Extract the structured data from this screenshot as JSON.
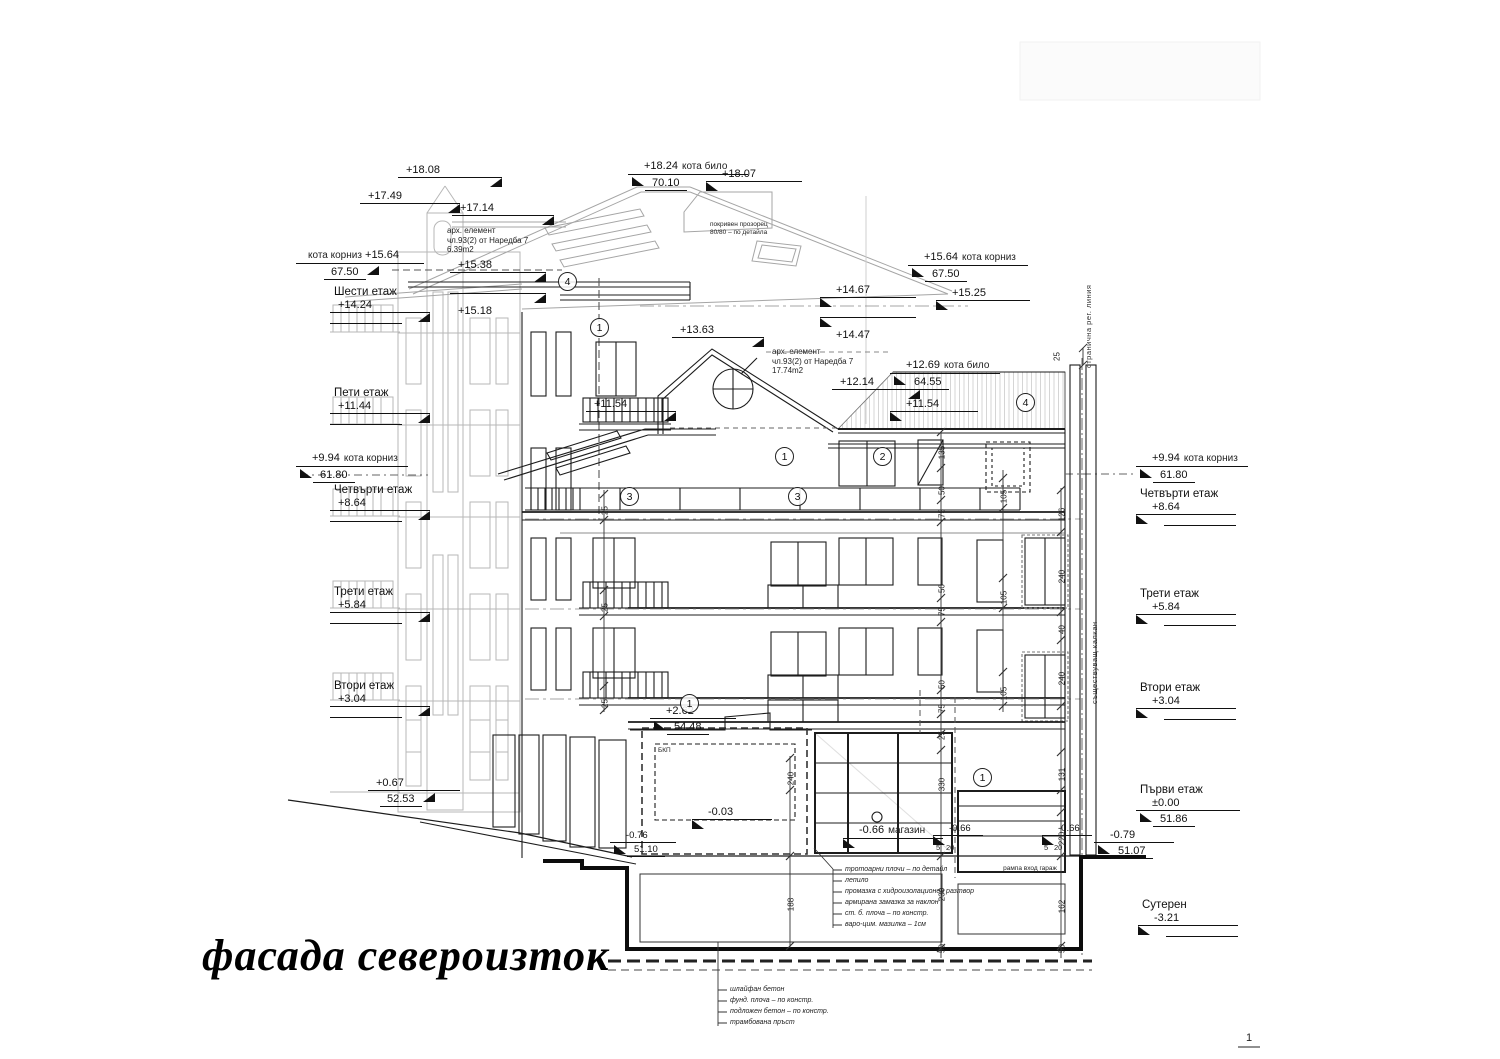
{
  "title": "фасада североизток",
  "page_number": "1",
  "levels": {
    "m1808": "+18.08",
    "m1749": "+17.49",
    "m1714": "+17.14",
    "m1824": "+18.24",
    "m1824_abs": "70.10",
    "m1807": "+18.07",
    "m1564": "+15.64",
    "m1564_abs": "67.50",
    "m1538": "+15.38",
    "m1518": "+15.18",
    "m1525": "+15.25",
    "m1467": "+14.67",
    "m1447": "+14.47",
    "m1363": "+13.63",
    "m1269": "+12.69",
    "m1269_abs": "64.55",
    "m1214": "+12.14",
    "m1154": "+11.54",
    "m994": "+9.94",
    "m994_abs": "61.80",
    "m262": "+2.62",
    "m262_abs": "54.48",
    "m003": "-0.03",
    "m066": "-0.66",
    "m076": "-0.76",
    "m076_abs": "51.10",
    "m079": "-0.79",
    "m079_abs": "51.07",
    "m067": "+0.67",
    "m067_abs": "52.53",
    "kota_bilo": "кота било",
    "kota_korniz": "кота корниз"
  },
  "floors_left": [
    {
      "name": "Шести етаж",
      "elev": "+14.24"
    },
    {
      "name": "Пети етаж",
      "elev": "+11.44"
    },
    {
      "name": "Четвърти етаж",
      "elev": "+8.64"
    },
    {
      "name": "Трети етаж",
      "elev": "+5.84"
    },
    {
      "name": "Втори етаж",
      "elev": "+3.04"
    }
  ],
  "floors_right": [
    {
      "name": "Четвърти етаж",
      "elev": "+8.64"
    },
    {
      "name": "Трети етаж",
      "elev": "+5.84"
    },
    {
      "name": "Втори етаж",
      "elev": "+3.04"
    },
    {
      "name": "Първи етаж",
      "elev": "±0.00",
      "abs": "51.86"
    },
    {
      "name": "Сутерен",
      "elev": "-3.21"
    }
  ],
  "callouts": {
    "c1": "1",
    "c2": "2",
    "c3": "3",
    "c4": "4"
  },
  "notes": {
    "arch1": [
      "арх. елемент",
      "чл.93(2) от Наредба 7",
      "6.39m2"
    ],
    "arch2": [
      "арх. елемент",
      "чл.93(2) от Наредба 7",
      "17.74m2"
    ],
    "roof_window": [
      "покривен прозорец",
      "80/80 – по детайла"
    ],
    "side_reg_line": "странична рег. линия",
    "party_wall": "съществуващ калкан",
    "bkp": "БКП",
    "shop": "магазин",
    "garage_ramp": "рампа вход гараж"
  },
  "materials_floor": [
    "тротоарни плочи – по детайл",
    "лепило",
    "промазка с хидроизолационен разтвор",
    "армирана замазка за наклон",
    "ст. б. плоча – по констр.",
    "варо-цим. мазилка – 1см"
  ],
  "materials_foundation": [
    "шлайфан бетон",
    "фунд. плоча – по констр.",
    "подложен бетон – по констр.",
    "трамбована пръст"
  ],
  "dims": {
    "d5": "5",
    "d20": "20",
    "d25": "25",
    "d40": "40",
    "d50": "50",
    "d75": "75",
    "d105": "105",
    "d126": "126",
    "d131": "131",
    "d135": "135",
    "d162": "162",
    "d188": "188",
    "d220": "220",
    "d230": "230",
    "d240": "240",
    "d330": "330"
  }
}
